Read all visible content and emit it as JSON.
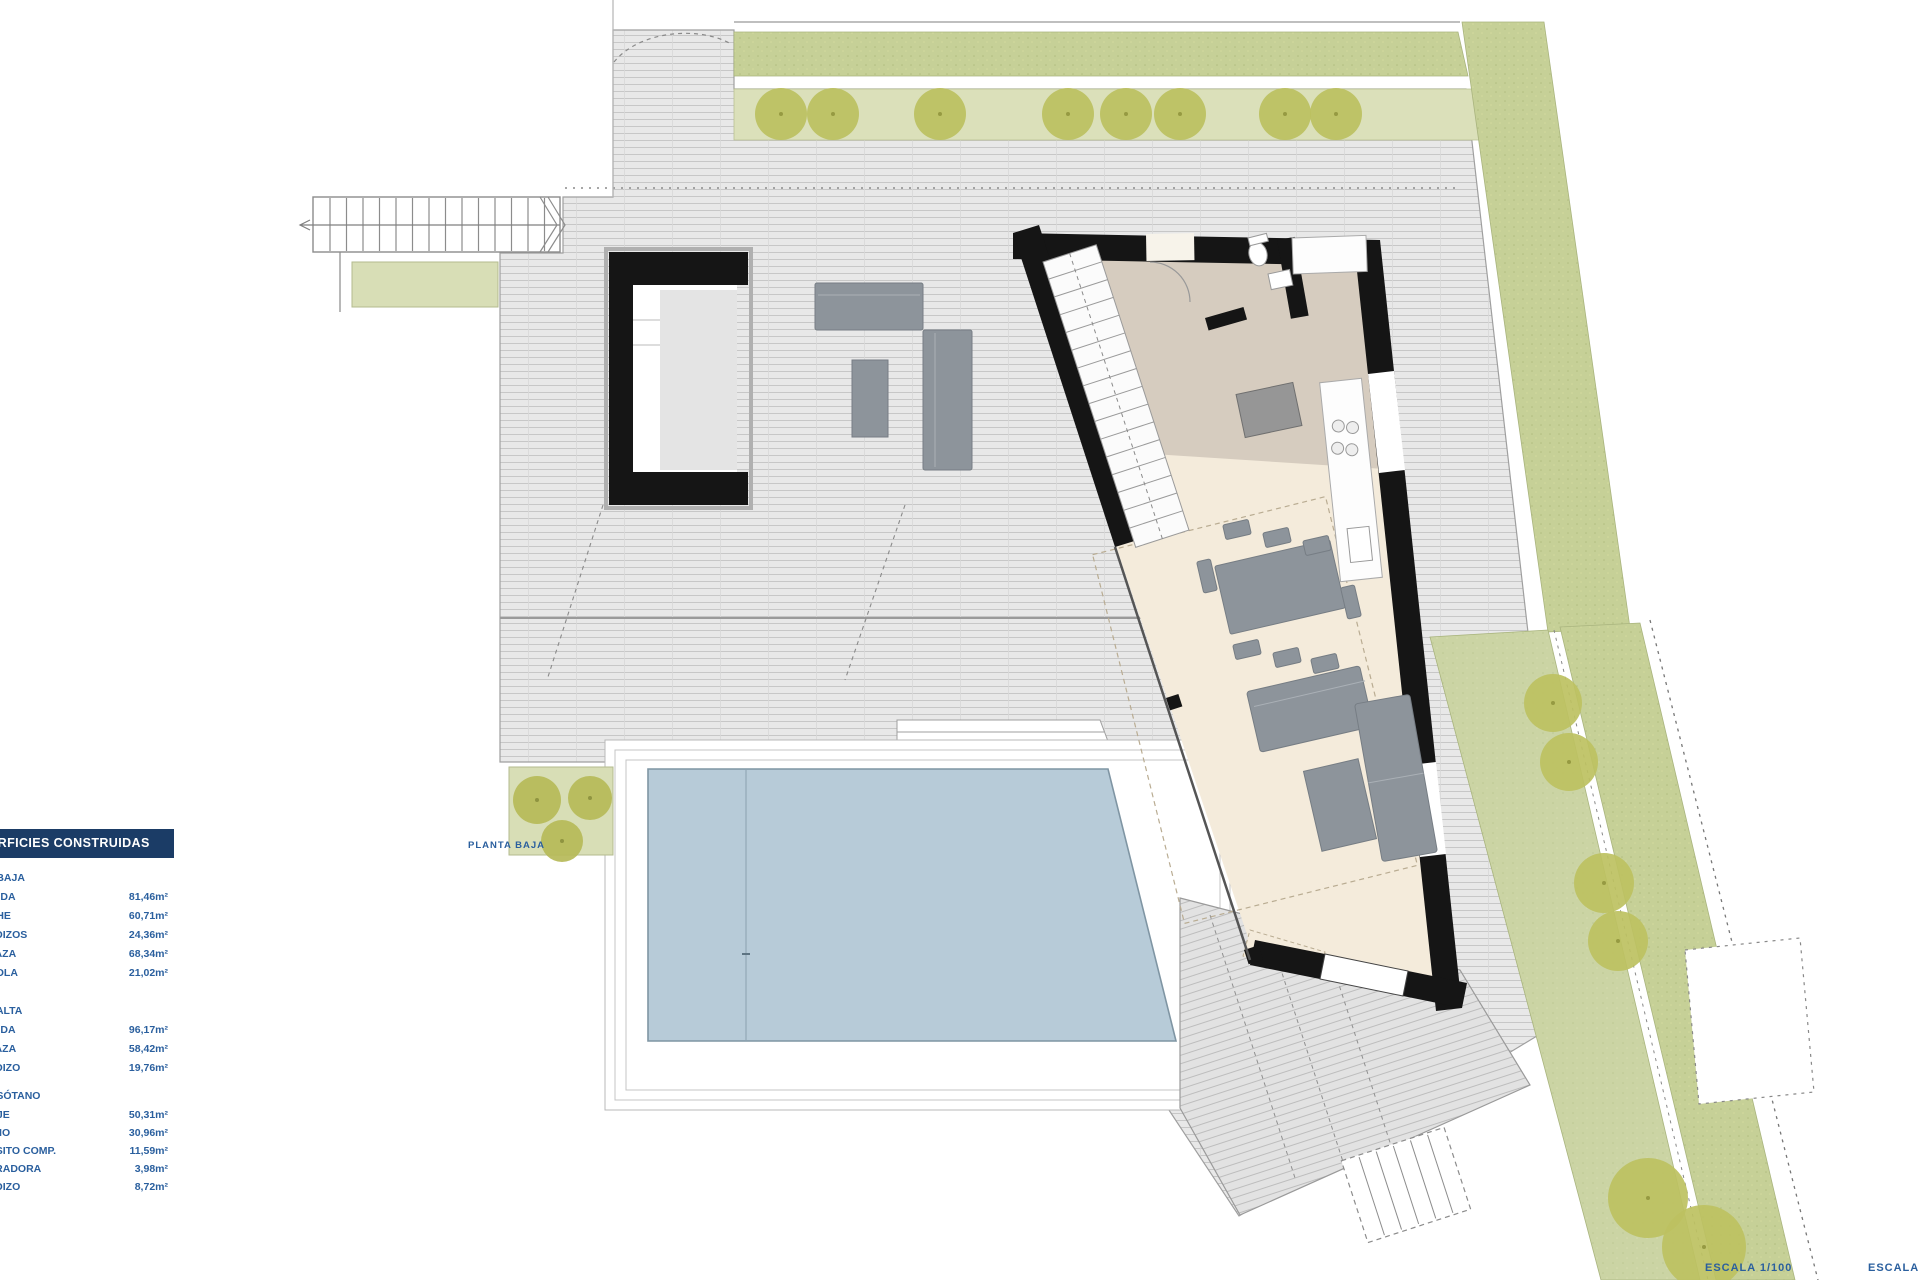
{
  "legend": {
    "title": "SUPERFICIES CONSTRUIDAS",
    "sections": [
      {
        "name": "PLANTA BAJA",
        "rows": [
          {
            "label": "VIVIENDA",
            "value": "81,46m²"
          },
          {
            "label": "PORCHE",
            "value": "60,71m²"
          },
          {
            "label": "VOLADIZOS",
            "value": "24,36m²"
          },
          {
            "label": "TERRAZA",
            "value": "68,34m²"
          },
          {
            "label": "PÉRGOLA",
            "value": "21,02m²"
          }
        ]
      },
      {
        "name": "PLANTA ALTA",
        "rows": [
          {
            "label": "VIVIENDA",
            "value": "96,17m²"
          },
          {
            "label": "TERRAZA",
            "value": "58,42m²"
          },
          {
            "label": "VOLADIZO",
            "value": "19,76m²"
          }
        ]
      },
      {
        "name": "PLANTA SÓTANO",
        "rows": [
          {
            "label": "GARAJE",
            "value": "50,31m²"
          },
          {
            "label": "SÓTANO",
            "value": "30,96m²"
          },
          {
            "label": "DEPÓSITO COMP.",
            "value": "11,59m²"
          },
          {
            "label": "DEPURADORA",
            "value": "3,98m²"
          },
          {
            "label": "VOLADIZO",
            "value": "8,72m²"
          }
        ]
      }
    ]
  },
  "labels": {
    "floor_label": "PLANTA BAJA",
    "scale_label": "ESCALA  1/100",
    "scale_label_right": "ESCALA GRÁFICA"
  },
  "colors": {
    "legend_bar": "#1b3c66",
    "legend_text": "#2a5f9e",
    "wall_black": "#151515",
    "slab_gray": "#e8e8e8",
    "pool_blue": "#b7cbd8",
    "grass_green": "#c6d097",
    "garden_green": "#cbd4a4",
    "tree_olive": "#bcc05f",
    "floor_cream": "#f4ebdb",
    "floor_taupe": "#d6ccbf",
    "furniture_gray": "#8d949b"
  }
}
